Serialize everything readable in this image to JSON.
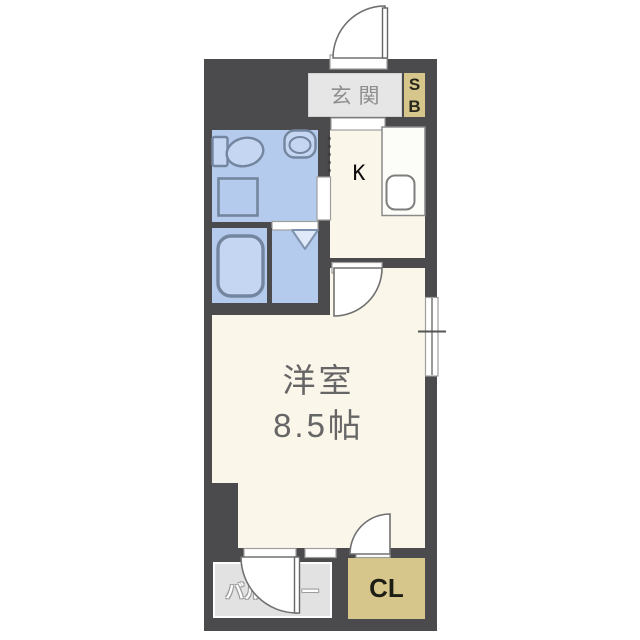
{
  "floorplan": {
    "entrance": {
      "label": "玄関"
    },
    "shoe_box": {
      "line1": "S",
      "line2": "B"
    },
    "kitchen": {
      "label": "K"
    },
    "main_room": {
      "name": "洋室",
      "size": "8.5帖"
    },
    "balcony": {
      "label": "バルコニー"
    },
    "closet": {
      "label": "CL"
    },
    "colors": {
      "wall": "#4b4b4d",
      "floor": "#fbf6ea",
      "wet_area": "#b5cbee",
      "fixture_fill": "#c5d6f3",
      "fixture_stroke": "#74869f",
      "accent_box": "#d6c68b",
      "gray_box": "#e6e6e6",
      "balcony_floor": "#e2e2e2"
    }
  }
}
